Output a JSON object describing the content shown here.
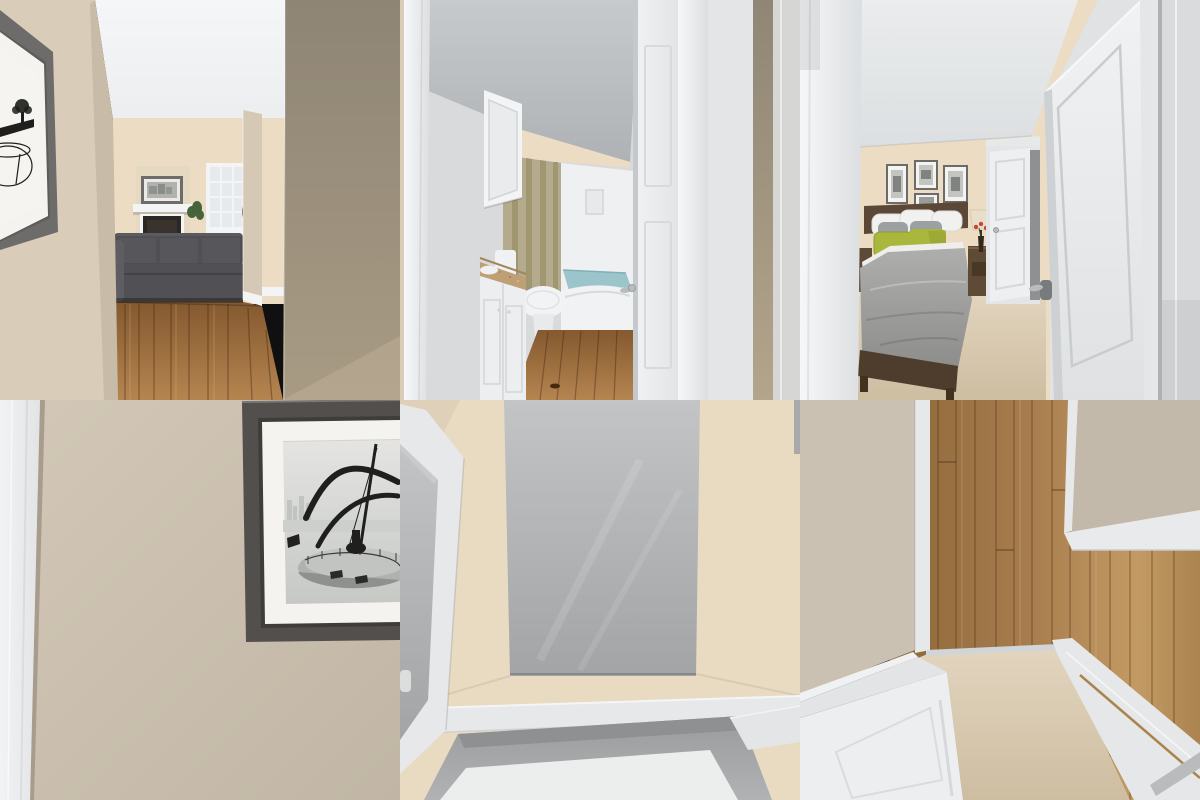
{
  "app": {
    "name": "interior-render-contact-sheet",
    "description": "2x3 grid of 3D interior renders of a staged apartment (no visible text in image)",
    "grid": {
      "rows": 2,
      "columns": 3,
      "tile_width_px": 400,
      "tile_height_px": 400
    }
  },
  "palette": {
    "beigeHall": "#d9cdba",
    "beigeHallDark": "#998f7e",
    "beigeWall4": "#cfc4b3",
    "beigeWarm": "#ecdcc3",
    "beigeCream": "#e9dbc2",
    "beigeP6L": "#cbc1b2",
    "beigeP6R": "#c3b9ab",
    "ceilWhite": "#f2f3f5",
    "ceilGray": "#b2b6b9",
    "trim": "#f3f4f6",
    "trimMid": "#e6e8ea",
    "trimShade": "#d2d5d7",
    "doorFace": "#edeff1",
    "edgeShadow": "#c6c9cb",
    "grayPanel": "#b9bbbd",
    "recess": "#a7a9ab",
    "recessDark": "#8e9092",
    "wood": "#9c6f3f",
    "woodDark": "#7d5530",
    "woodLight": "#b58550",
    "carpet": "#ddcfb8",
    "carpetDeep": "#cdbda1",
    "sofa": "#57575b",
    "sofaDark": "#454549",
    "frame1": "#6e6c6a",
    "frame4": "#524f4c",
    "mat": "#f4f3f0",
    "photoLight": "#e2e3e1",
    "photoMid": "#c9cbc8",
    "photoDark": "#b0b2af",
    "ink": "#1f1f1d",
    "green": "#a9b73d",
    "greenDeep": "#8d9c2f",
    "comforter": "#a6a6a4",
    "pillowGray": "#9da0a2",
    "white": "#f1f1ef",
    "headboard": "#5c4836",
    "woodFurn": "#5f4a35",
    "granite": "#bf9f74",
    "curtain": "#b4aa8d",
    "curtainDeep": "#a0966f",
    "water": "#9cc5cb",
    "waterDeep": "#7fb0b8",
    "red": "#c14736",
    "plant": "#46633a",
    "lamp": "#e9dec9",
    "silver": "#b9bcbf",
    "firebox": "#2b2724"
  },
  "panels": [
    {
      "id": "hallway-living-room",
      "position": "top-left",
      "label": "Hallway with dark-framed black-and-white artwork looking into a living room with gray sofa, fireplace, mantel art, gridded window, plants and oak wood floor",
      "objects": [
        "hall-art-frame",
        "left-wall",
        "right-wall",
        "ceiling",
        "fireplace",
        "mantel-artwork",
        "window",
        "sofa",
        "plants",
        "wood-floor"
      ]
    },
    {
      "id": "bathroom",
      "position": "top-center",
      "label": "Narrow bathroom seen through an open white door: white vanity with tan granite top, medicine cabinet, toilet, tan shower curtain, tub filled with blue water, wood floor",
      "objects": [
        "door-jamb",
        "gray-ceiling",
        "medicine-cabinet",
        "shower-curtain",
        "tub-with-water",
        "toilet",
        "granite-vanity",
        "open-door",
        "wood-floor"
      ]
    },
    {
      "id": "bedroom",
      "position": "top-right",
      "label": "Bedroom seen past an open white door: gallery wall of four black-and-white prints, bed with gray comforter and chartreuse accent pillows, nightstand with lamp and red flowers, beige carpet",
      "objects": [
        "door-jamb",
        "ceiling",
        "gallery-frames",
        "bed",
        "green-pillows",
        "nightstand",
        "table-lamp",
        "red-flowers",
        "middle-door",
        "open-door",
        "carpet-floor"
      ]
    },
    {
      "id": "framed-art-closeup",
      "position": "bottom-left",
      "label": "Close-up of a dark gray framed black-and-white photograph of a sundial sculpture on a circular railed platform, hung on a beige wall next to white door trim",
      "objects": [
        "white-trim",
        "beige-wall",
        "art-frame",
        "white-mat",
        "sundial-photo"
      ]
    },
    {
      "id": "overhead-alcove",
      "position": "bottom-center",
      "label": "Overhead view of a cream-walled space with a large gray wall panel, white trim band and a gray recessed alcove with white floor; angled white door frame at left",
      "objects": [
        "cream-walls",
        "gray-wall-panel",
        "white-trim-band",
        "recessed-alcove",
        "angled-door-frame"
      ]
    },
    {
      "id": "doorway-threshold",
      "position": "bottom-right",
      "label": "Top-down view of a doorway threshold: oak plank floor meeting beige carpet, open white doors and trim seen from above on both sides",
      "objects": [
        "wood-plank-floor",
        "carpet-floor",
        "left-wall",
        "left-open-door",
        "right-wall",
        "right-trim-bands"
      ]
    }
  ]
}
